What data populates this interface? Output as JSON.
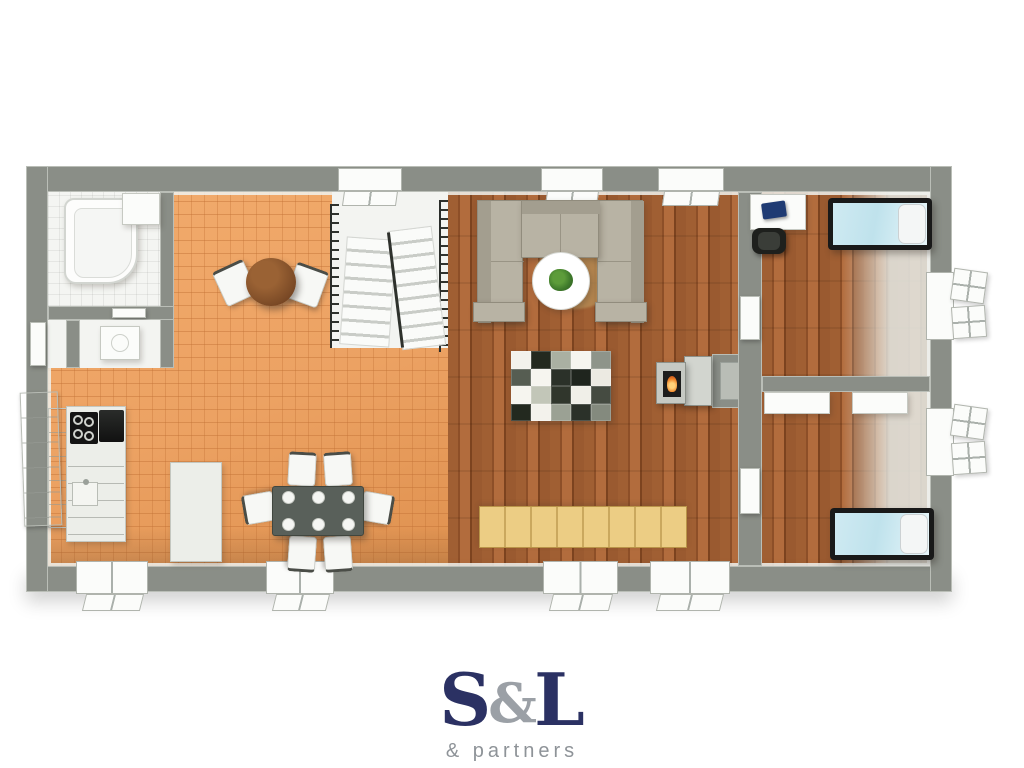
{
  "logo": {
    "part1": "S",
    "amp": "&",
    "part2": "L",
    "subtitle": "& partners",
    "navy_color": "#2b3163",
    "gray_color": "#9ba0a6"
  },
  "palette": {
    "wall": "#8a8e87",
    "wall_light": "#b9bdb6",
    "tile_floor": "#eca263",
    "tile_line": "#d88d4f",
    "wood_floor": "#9a5a30",
    "white_floor": "#f3f4f1",
    "sofa": "#b8b3a4",
    "bed_cover": "#c5e4ee",
    "bench_wood": "#e8c87e",
    "fire": "#f08428",
    "table_dark": "#59605a",
    "bistro_table": "#7b4a26"
  },
  "floorplan": {
    "rooms": [
      {
        "name": "bathroom"
      },
      {
        "name": "toilet-room"
      },
      {
        "name": "kitchen-dining"
      },
      {
        "name": "staircase"
      },
      {
        "name": "living-room"
      },
      {
        "name": "bedroom-1"
      },
      {
        "name": "bedroom-2"
      }
    ],
    "rug_cells": [
      "#f3f2ec",
      "#23291f",
      "#aab0a2",
      "#f6f5ef",
      "#8e948a",
      "#565d52",
      "#f6f5ef",
      "#2b3129",
      "#1f251e",
      "#eceae2",
      "#f6f5ef",
      "#c2c6b8",
      "#30362c",
      "#f0efe8",
      "#454b41",
      "#23291f",
      "#f3f2ec",
      "#9ba194",
      "#2b3129",
      "#848a7e"
    ]
  }
}
